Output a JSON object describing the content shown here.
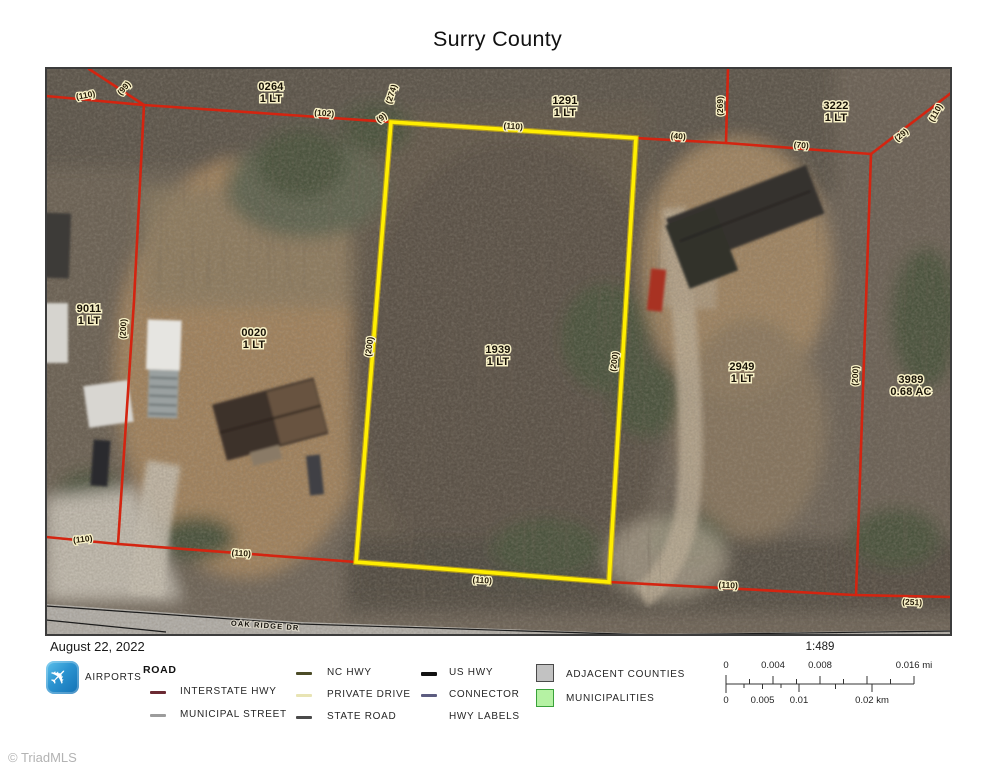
{
  "title": "Surry County",
  "map": {
    "street_label": "OAK RIDGE DR",
    "colors": {
      "parcel_line": "#d42410",
      "highlight_parcel": "#ffee00",
      "label_halo": "#f7f0c6"
    },
    "parcels": [
      {
        "id": "0264",
        "size": "1 LT",
        "x": 225,
        "y": 22
      },
      {
        "id": "1291",
        "size": "1 LT",
        "x": 519,
        "y": 36
      },
      {
        "id": "3222",
        "size": "1 LT",
        "x": 790,
        "y": 41
      },
      {
        "id": "9011",
        "size": "1 LT",
        "x": 43,
        "y": 244
      },
      {
        "id": "0020",
        "size": "1 LT",
        "x": 208,
        "y": 268
      },
      {
        "id": "1939",
        "size": "1 LT",
        "x": 452,
        "y": 285
      },
      {
        "id": "2949",
        "size": "1 LT",
        "x": 696,
        "y": 302
      },
      {
        "id": "3989",
        "size": "0.68 AC",
        "x": 865,
        "y": 315
      }
    ],
    "dimensions": [
      {
        "t": "(110)",
        "x": 40,
        "y": 30,
        "r": -10
      },
      {
        "t": "(99)",
        "x": 80,
        "y": 22,
        "r": -48
      },
      {
        "t": "(102)",
        "x": 278,
        "y": 48,
        "r": 4
      },
      {
        "t": "(274)",
        "x": 348,
        "y": 27,
        "r": -72
      },
      {
        "t": "(9)",
        "x": 337,
        "y": 52,
        "r": -35
      },
      {
        "t": "(110)",
        "x": 467,
        "y": 61,
        "r": 4
      },
      {
        "t": "(40)",
        "x": 632,
        "y": 71,
        "r": 4
      },
      {
        "t": "(269)",
        "x": 677,
        "y": 38,
        "r": -90
      },
      {
        "t": "(70)",
        "x": 755,
        "y": 80,
        "r": 4
      },
      {
        "t": "(29)",
        "x": 857,
        "y": 69,
        "r": -40
      },
      {
        "t": "(110)",
        "x": 892,
        "y": 46,
        "r": -60
      },
      {
        "t": "(200)",
        "x": 80,
        "y": 261,
        "r": -87
      },
      {
        "t": "(200)",
        "x": 326,
        "y": 279,
        "r": -82
      },
      {
        "t": "(200)",
        "x": 571,
        "y": 294,
        "r": -82
      },
      {
        "t": "(200)",
        "x": 812,
        "y": 308,
        "r": -87
      },
      {
        "t": "(110)",
        "x": 37,
        "y": 474,
        "r": -6
      },
      {
        "t": "(110)",
        "x": 195,
        "y": 488,
        "r": 4
      },
      {
        "t": "(110)",
        "x": 436,
        "y": 515,
        "r": 4
      },
      {
        "t": "(110)",
        "x": 682,
        "y": 520,
        "r": 3
      },
      {
        "t": "(251)",
        "x": 866,
        "y": 537,
        "r": 3
      }
    ]
  },
  "legend": {
    "date": "August 22, 2022",
    "airports_label": "AIRPORTS",
    "airport_glyph": "✈",
    "road_header": "ROAD",
    "road_items": [
      {
        "label": "INTERSTATE HWY",
        "color": "#6b2a33"
      },
      {
        "label": "MUNICIPAL STREET",
        "color": "#9c9c9c"
      },
      {
        "label": "NC HWY",
        "color": "#4c4c28"
      },
      {
        "label": "PRIVATE DRIVE",
        "color": "#e8e4b4"
      },
      {
        "label": "STATE ROAD",
        "color": "#4a4a4a"
      },
      {
        "label": "US HWY",
        "color": "#121212"
      },
      {
        "label": "CONNECTOR",
        "color": "#5c5c80"
      },
      {
        "label": "HWY LABELS",
        "color": null
      }
    ],
    "area_items": [
      {
        "label": "ADJACENT COUNTIES",
        "fill": "#c2c2c2",
        "border": "#4a4a4a"
      },
      {
        "label": "MUNICIPALITIES",
        "fill": "#b5f2a3",
        "border": "#3aa13a"
      }
    ],
    "scale": {
      "ratio": "1:489",
      "mi_ticks": [
        "0",
        "0.004",
        "0.008",
        "0.016 mi"
      ],
      "km_ticks": [
        "0",
        "0.005",
        "0.01",
        "0.02 km"
      ]
    }
  },
  "footer": {
    "watermark": "© TriadMLS"
  }
}
